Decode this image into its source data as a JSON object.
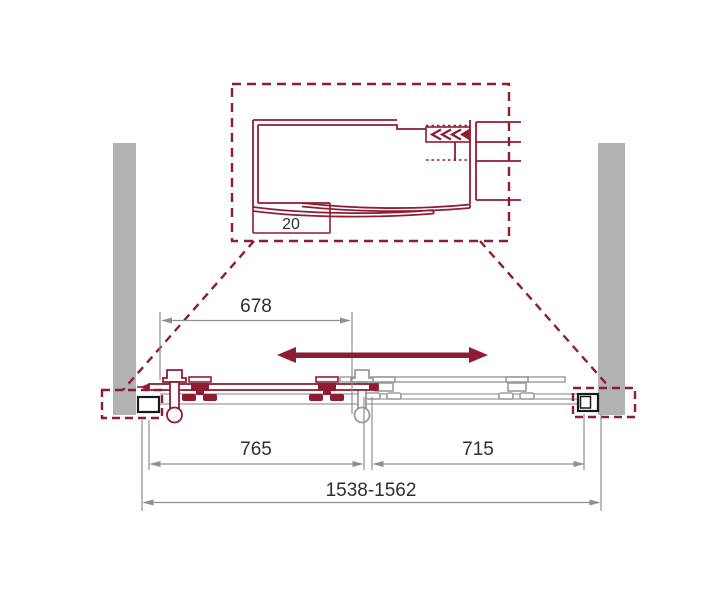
{
  "detail_view": {
    "adjustment": "20"
  },
  "dimensions": {
    "top_width": "678",
    "left_panel_width": "765",
    "right_panel_width": "715",
    "overall_width_range": "1538-1562"
  },
  "colors": {
    "accent_red": "#8e1d33",
    "wall_gray": "#b2b2b2",
    "hardware_gray": "#9b9b9b",
    "dimension_gray": "#8f8f8f",
    "profile_black": "#1a1a1a",
    "text_dark": "#2e2e2e",
    "background": "#ffffff"
  },
  "icons": {
    "slide_direction": "double-headed-horizontal-arrow",
    "seal_chevrons": "triple-left-chevron"
  }
}
